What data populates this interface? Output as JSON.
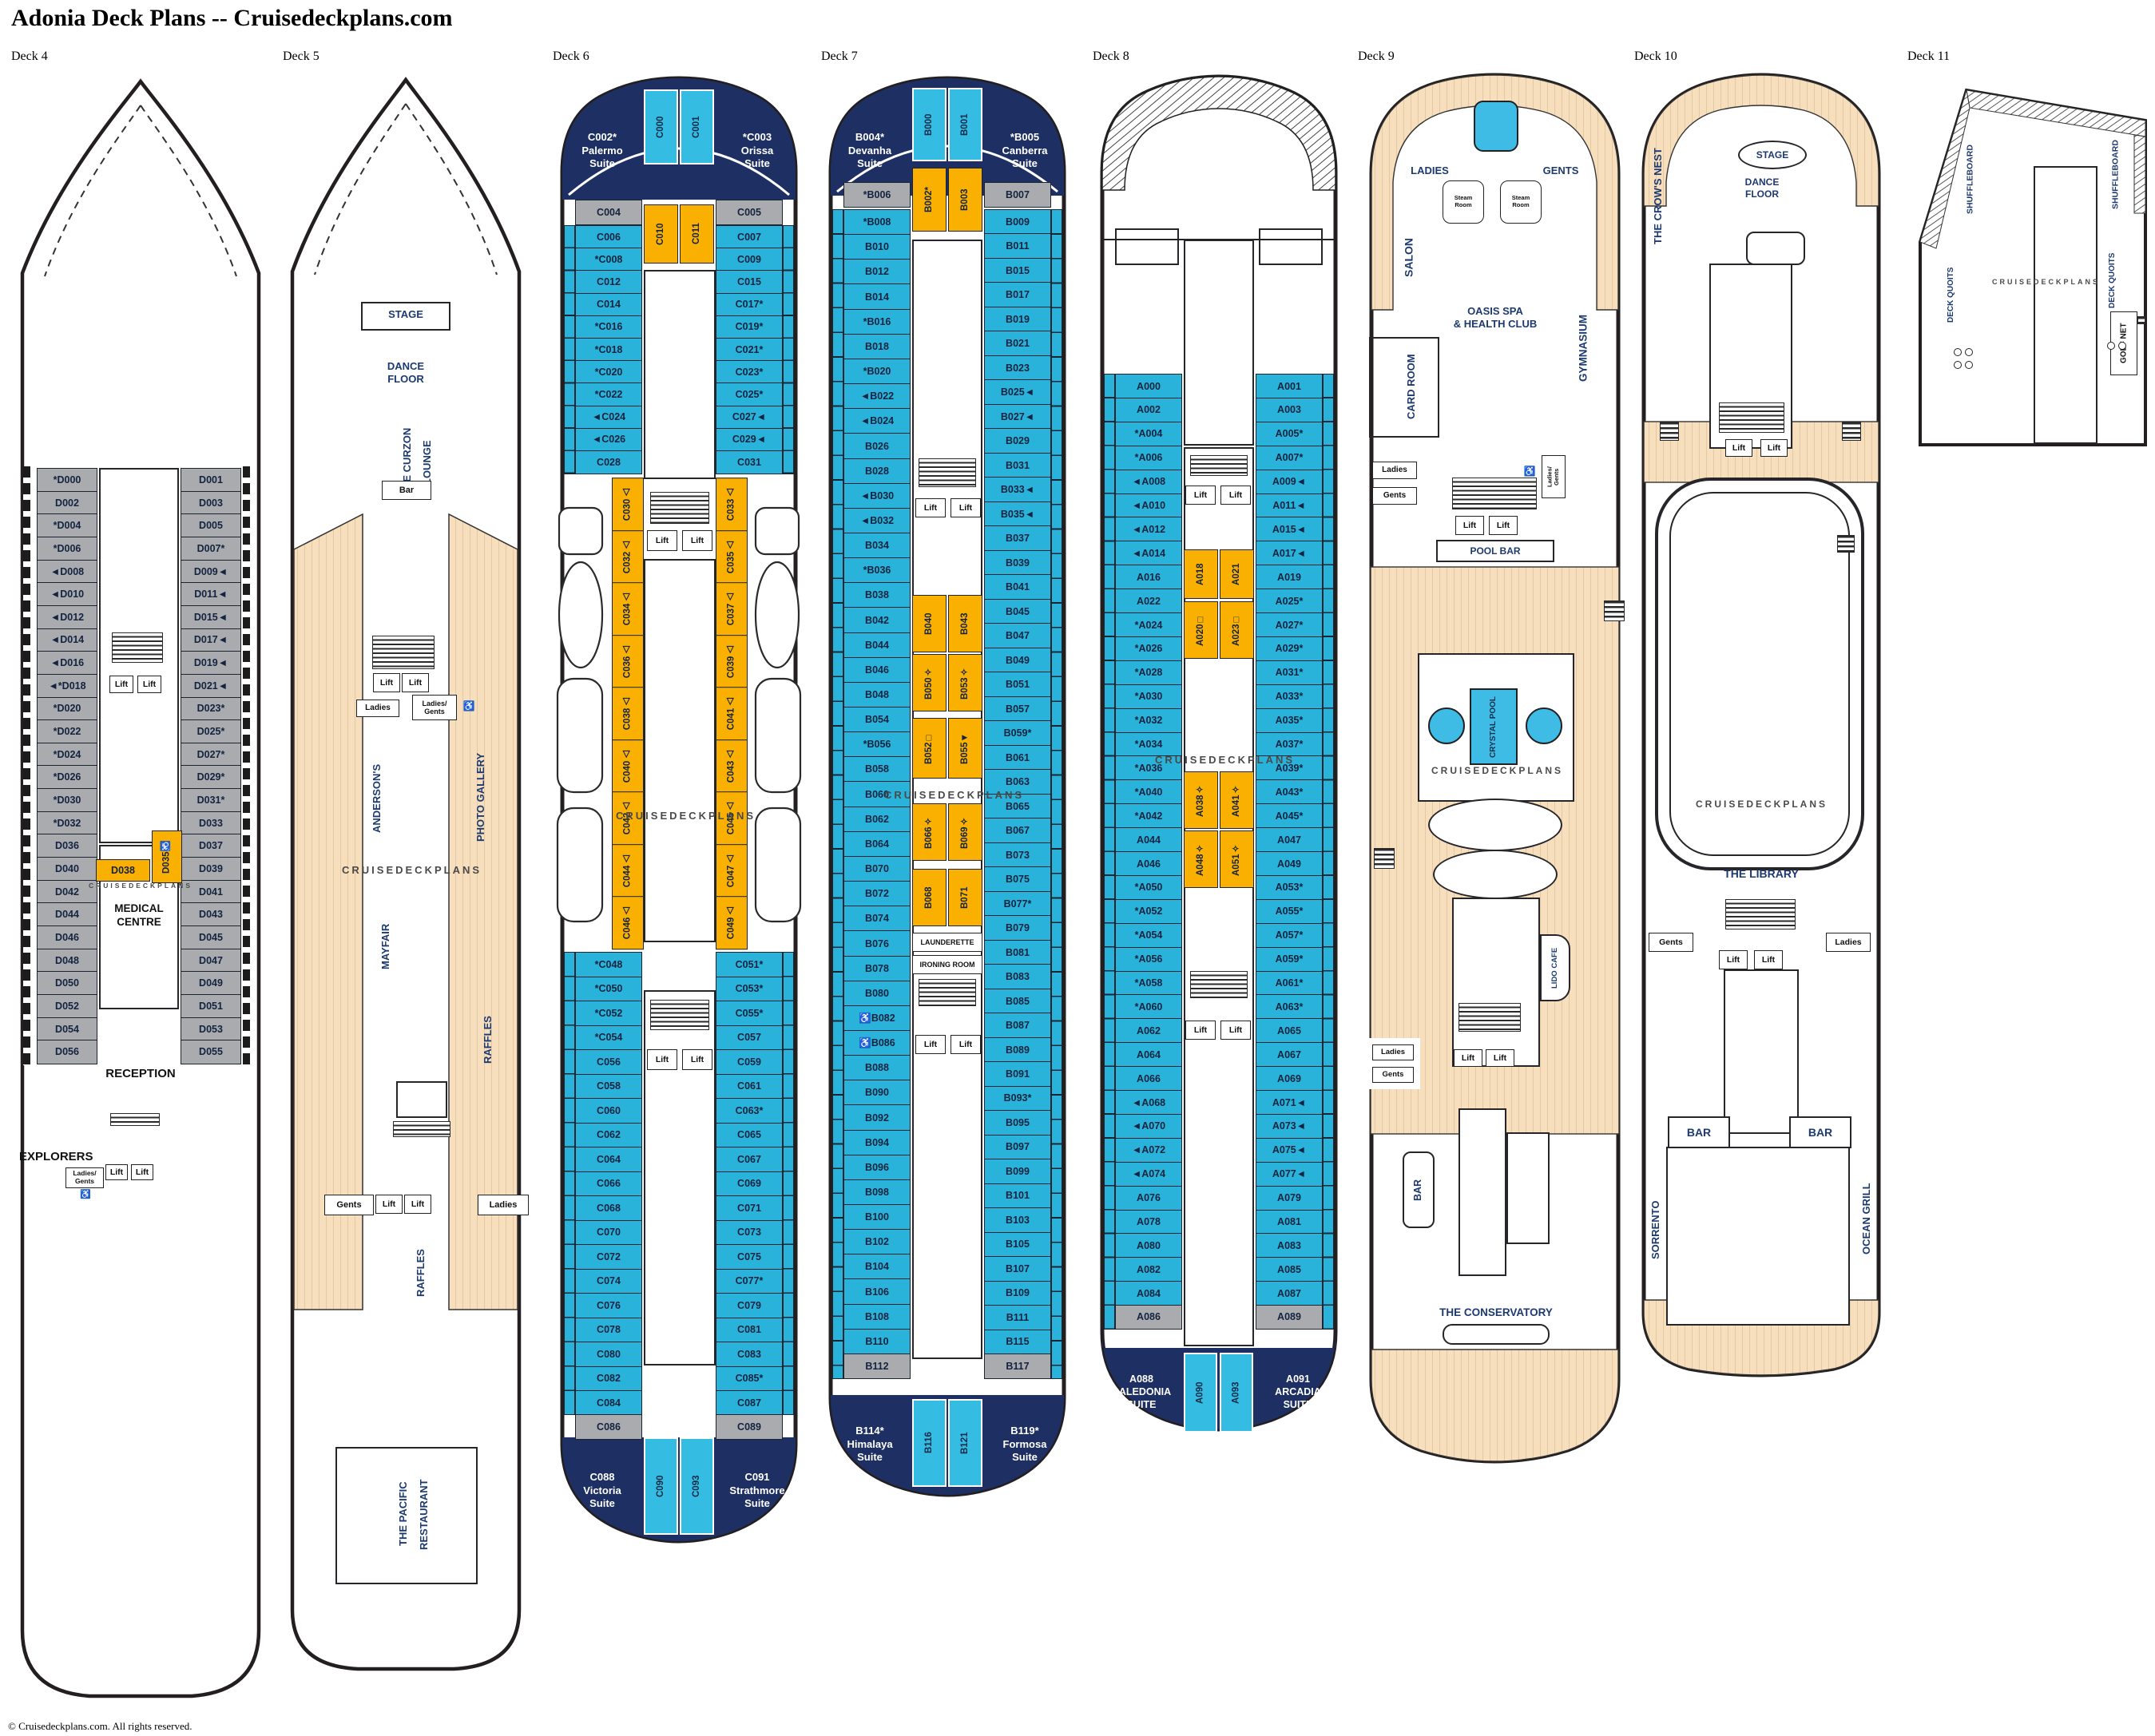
{
  "title": "Adonia Deck Plans -- Cruisedeckplans.com",
  "footer": "© Cruisedeckplans.com. All rights reserved.",
  "labels": {
    "lift": "Lift",
    "ladies": "Ladies",
    "gents": "Gents",
    "ladies_gents": "Ladies/\nGents",
    "steam": "Steam\nRoom",
    "accessible": "♿",
    "watermark": "CRUISEDECKPLANS"
  },
  "colors": {
    "navy": "#1e2f63",
    "cabin_blue": "#2ab3da",
    "cabin_orange": "#f9b000",
    "cabin_gray": "#a9abae",
    "deck_tan": "#f7debc",
    "pool_blue": "#3fbce6"
  },
  "decks": [
    {
      "label": "Deck 4",
      "left": [
        "*D000",
        "D002",
        "*D004",
        "*D006",
        "◄D008",
        "◄D010",
        "◄D012",
        "◄D014",
        "◄D016",
        "◄*D018",
        "*D020",
        "*D022",
        "*D024",
        "*D026",
        "*D030",
        "*D032",
        "D036",
        "D040",
        "D042",
        "D044",
        "D046",
        "D048",
        "D050",
        "D052",
        "D054",
        "D056"
      ],
      "right": [
        "D001",
        "D003",
        "D005",
        "D007*",
        "D009◄",
        "D011◄",
        "D015◄",
        "D017◄",
        "D019◄",
        "D021◄",
        "D023*",
        "D025*",
        "D027*",
        "D029*",
        "D031*",
        "D033",
        "D037",
        "D039",
        "D041",
        "D043",
        "D045",
        "D047",
        "D049",
        "D051",
        "D053",
        "D055"
      ],
      "mid": [
        "D038",
        "D035♿"
      ],
      "rooms": {
        "medical": "MEDICAL\nCENTRE",
        "reception": "RECEPTION",
        "explorers": "EXPLORERS"
      }
    },
    {
      "label": "Deck 5",
      "rooms": {
        "stage": "STAGE",
        "dance": "DANCE\nFLOOR",
        "curzon1": "THE CURZON",
        "curzon2": "LOUNGE",
        "bar": "Bar",
        "andersons": "ANDERSON'S",
        "photo": "PHOTO GALLERY",
        "mayfair": "MAYFAIR",
        "raffles": "RAFFLES",
        "pacific1": "THE PACIFIC",
        "pacific2": "RESTAURANT"
      }
    },
    {
      "label": "Deck 6",
      "bow": {
        "left": "C002*\nPalermo\nSuite",
        "mid": [
          "C000",
          "C001"
        ],
        "right": "*C003\nOrissa\nSuite"
      },
      "gray_row": [
        "C004",
        "C005"
      ],
      "upper_mid": [
        "C010",
        "C011"
      ],
      "upper_left": [
        "C006",
        "*C008",
        "C012",
        "C014",
        "*C016",
        "*C018",
        "*C020",
        "*C022",
        "◄C024",
        "◄C026",
        "C028"
      ],
      "upper_right": [
        "C007",
        "C009",
        "C015",
        "C017*",
        "C019*",
        "C021*",
        "C023*",
        "C025*",
        "C027◄",
        "C029◄",
        "C031"
      ],
      "mid_left": [
        "C030△",
        "C032△",
        "C034△",
        "C036△",
        "C038△",
        "C040△",
        "C042△",
        "C044△",
        "C046△"
      ],
      "mid_right": [
        "C033△",
        "C035△",
        "C037△",
        "C039△",
        "C041△",
        "C043△",
        "C045△",
        "C047△",
        "C049△"
      ],
      "lower_left": [
        "*C048",
        "*C050",
        "*C052",
        "*C054",
        "C056",
        "C058",
        "C060",
        "C062",
        "C064",
        "C066",
        "C068",
        "C070",
        "C072",
        "C074",
        "C076",
        "C078",
        "C080",
        "C082",
        "C084"
      ],
      "lower_right": [
        "C051*",
        "C053*",
        "C055*",
        "C057",
        "C059",
        "C061",
        "C063*",
        "C065",
        "C067",
        "C069",
        "C071",
        "C073",
        "C075",
        "C077*",
        "C079",
        "C081",
        "C083",
        "C085*",
        "C087"
      ],
      "gray_bottom": [
        "C086",
        "C089"
      ],
      "stern": {
        "left": "C088\nVictoria\nSuite",
        "mid": [
          "C090",
          "C093"
        ],
        "right": "C091\nStrathmore\nSuite"
      }
    },
    {
      "label": "Deck 7",
      "bow": {
        "left": "B004*\nDevanha\nSuite",
        "mid": [
          "B000",
          "B001"
        ],
        "right": "*B005\nCanberra\nSuite"
      },
      "gray_row": [
        "*B006",
        "B007"
      ],
      "oranges": [
        [
          "B002*",
          "B003"
        ],
        [
          "B040",
          "B043"
        ],
        [
          "B050✧",
          "B053✧"
        ],
        [
          "B052□",
          "B055◄"
        ],
        [
          "B066✧",
          "B069✧"
        ],
        [
          "B068",
          "B071"
        ]
      ],
      "left": [
        "*B008",
        "B010",
        "B012",
        "B014",
        "*B016",
        "B018",
        "*B020",
        "◄B022",
        "◄B024",
        "B026",
        "B028",
        "◄B030",
        "◄B032",
        "B034",
        "*B036",
        "B038",
        "B042",
        "B044",
        "B046",
        "B048",
        "B054",
        "*B056",
        "B058",
        "B060",
        "B062",
        "B064",
        "B070",
        "B072",
        "B074",
        "B076",
        "B078",
        "B080",
        "♿B082",
        "♿B086",
        "B088",
        "B090",
        "B092",
        "B094",
        "B096",
        "B098",
        "B100",
        "B102",
        "B104",
        "B106",
        "B108",
        "B110"
      ],
      "right": [
        "B009",
        "B011",
        "B015",
        "B017",
        "B019",
        "B021",
        "B023",
        "B025◄",
        "B027◄",
        "B029",
        "B031",
        "B033◄",
        "B035◄",
        "B037",
        "B039",
        "B041",
        "B045",
        "B047",
        "B049",
        "B051",
        "B057",
        "B059*",
        "B061",
        "B063",
        "B065",
        "B067",
        "B073",
        "B075",
        "B077*",
        "B079",
        "B081",
        "B083",
        "B085",
        "B087",
        "B089",
        "B091",
        "B093*",
        "B095",
        "B097",
        "B099",
        "B101",
        "B103",
        "B105",
        "B107",
        "B109",
        "B111",
        "B115"
      ],
      "gray_bottom": [
        "B112",
        "B117"
      ],
      "rooms": {
        "laund": "LAUNDERETTE",
        "iron": "IRONING ROOM"
      },
      "stern": {
        "left": "B114*\nHimalaya\nSuite",
        "mid": [
          "B116",
          "B121"
        ],
        "right": "B119*\nFormosa\nSuite"
      }
    },
    {
      "label": "Deck 8",
      "left": [
        "A000",
        "A002",
        "*A004",
        "*A006",
        "◄A008",
        "◄A010",
        "◄A012",
        "◄A014",
        "A016",
        "A022",
        "*A024",
        "*A026",
        "*A028",
        "*A030",
        "*A032",
        "*A034",
        "*A036",
        "*A040",
        "*A042",
        "A044",
        "A046",
        "*A050",
        "*A052",
        "*A054",
        "*A056",
        "*A058",
        "*A060",
        "A062",
        "A064",
        "A066",
        "◄A068",
        "◄A070",
        "◄A072",
        "◄A074",
        "A076",
        "A078",
        "A080",
        "A082",
        "A084"
      ],
      "right": [
        "A001",
        "A003",
        "A005*",
        "A007*",
        "A009◄",
        "A011◄",
        "A015◄",
        "A017◄",
        "A019",
        "A025*",
        "A027*",
        "A029*",
        "A031*",
        "A033*",
        "A035*",
        "A037*",
        "A039*",
        "A043*",
        "A045*",
        "A047",
        "A049",
        "A053*",
        "A055*",
        "A057*",
        "A059*",
        "A061*",
        "A063*",
        "A065",
        "A067",
        "A069",
        "A071◄",
        "A073◄",
        "A075◄",
        "A077◄",
        "A079",
        "A081",
        "A083",
        "A085",
        "A087"
      ],
      "gray_bottom": [
        "A086",
        "A089"
      ],
      "oranges": [
        [
          "A018",
          "A021"
        ],
        [
          "A020□",
          "A023□"
        ],
        [
          "A038✧",
          "A041✧"
        ],
        [
          "A048✧",
          "A051✧"
        ]
      ],
      "stern": {
        "left": "A088\nCALEDONIA\nSUITE",
        "mid": [
          "A090",
          "A093"
        ],
        "right": "A091\nARCADIA\nSUITE"
      }
    },
    {
      "label": "Deck 9",
      "rooms": {
        "ladies_u": "LADIES",
        "gents_u": "GENTS",
        "salon": "SALON",
        "oasis": "OASIS SPA\n& HEALTH CLUB",
        "card": "CARD ROOM",
        "gym": "GYMNASIUM",
        "poolbar": "POOL BAR",
        "crystal": "CRYSTAL POOL",
        "lido": "LIDO CAFE",
        "bar": "BAR",
        "conservatory": "THE CONSERVATORY"
      }
    },
    {
      "label": "Deck 10",
      "rooms": {
        "crow": "THE CROW'S NEST",
        "stage": "STAGE",
        "dance": "DANCE\nFLOOR",
        "library": "THE LIBRARY",
        "bar": "BAR",
        "sorrento": "SORRENTO",
        "ocean": "OCEAN GRILL"
      }
    },
    {
      "label": "Deck 11",
      "rooms": {
        "shuffle": "SHUFFLEBOARD",
        "quoits": "DECK QUOITS",
        "golf": "GOLF NET"
      }
    }
  ]
}
